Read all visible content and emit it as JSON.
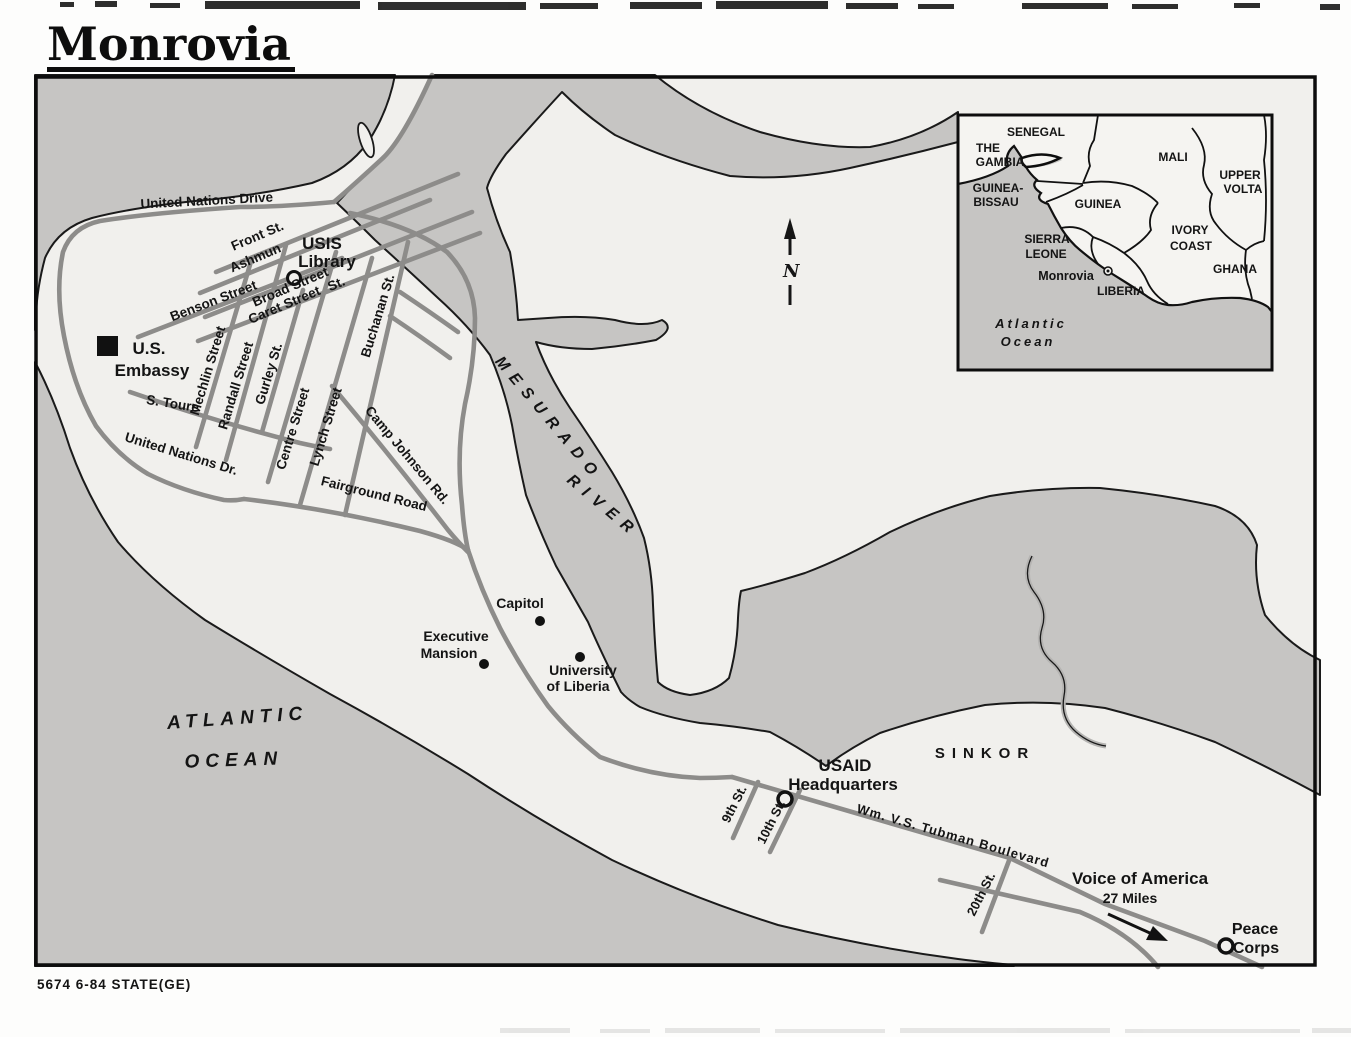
{
  "title": "Monrovia",
  "credit": "5674 6-84 STATE(GE)",
  "colors": {
    "water": "#c6c5c3",
    "land": "#f1f0ed",
    "road": "#8d8c8a",
    "ink": "#141414",
    "paper": "#fdfdfc"
  },
  "map": {
    "north_label": "N",
    "streets": {
      "united_nations_drive": "United Nations Drive",
      "front": "Front St.",
      "ashmun": "Ashmun",
      "ashmun_st": "St.",
      "broad": "Broad Street",
      "caret": "Caret Street",
      "benson": "Benson Street",
      "mechlin": "Mechlin Street",
      "randall": "Randall Street",
      "gurley": "Gurley St.",
      "centre": "Centre Street",
      "lynch": "Lynch Street",
      "buchanan": "Buchanan St.",
      "camp_johnson": "Camp Johnson Rd.",
      "s_toure": "S. Toure",
      "united_nations_dr": "United Nations Dr.",
      "fairground": "Fairground Road",
      "tubman": "Wm. V.S. Tubman Boulevard",
      "ninth": "9th St.",
      "tenth": "10th St.",
      "twentieth": "20th St."
    },
    "places": {
      "usis_line1": "USIS",
      "usis_line2": "Library",
      "embassy_line1": "U.S.",
      "embassy_line2": "Embassy",
      "capitol": "Capitol",
      "executive_line1": "Executive",
      "executive_line2": "Mansion",
      "university_line1": "University",
      "university_line2": "of Liberia",
      "usaid_line1": "USAID",
      "usaid_line2": "Headquarters",
      "sinkor": "SINKOR",
      "voa_line1": "Voice of America",
      "voa_line2": "27 Miles",
      "peace_line1": "Peace",
      "peace_line2": "Corps"
    },
    "water_labels": {
      "mesurado_1": "MESURADO",
      "mesurado_2": "RIVER",
      "atlantic_1": "ATLANTIC",
      "atlantic_2": "OCEAN"
    }
  },
  "inset": {
    "countries": {
      "senegal": "SENEGAL",
      "gambia_1": "THE",
      "gambia_2": "GAMBIA",
      "gb_1": "GUINEA-",
      "gb_2": "BISSAU",
      "guinea": "GUINEA",
      "mali": "MALI",
      "uv_1": "UPPER",
      "uv_2": "VOLTA",
      "ivory_1": "IVORY",
      "ivory_2": "COAST",
      "ghana": "GHANA",
      "sl_1": "SIERRA",
      "sl_2": "LEONE",
      "liberia": "LIBERIA"
    },
    "city": "Monrovia",
    "ocean_1": "Atlantic",
    "ocean_2": "Ocean"
  }
}
